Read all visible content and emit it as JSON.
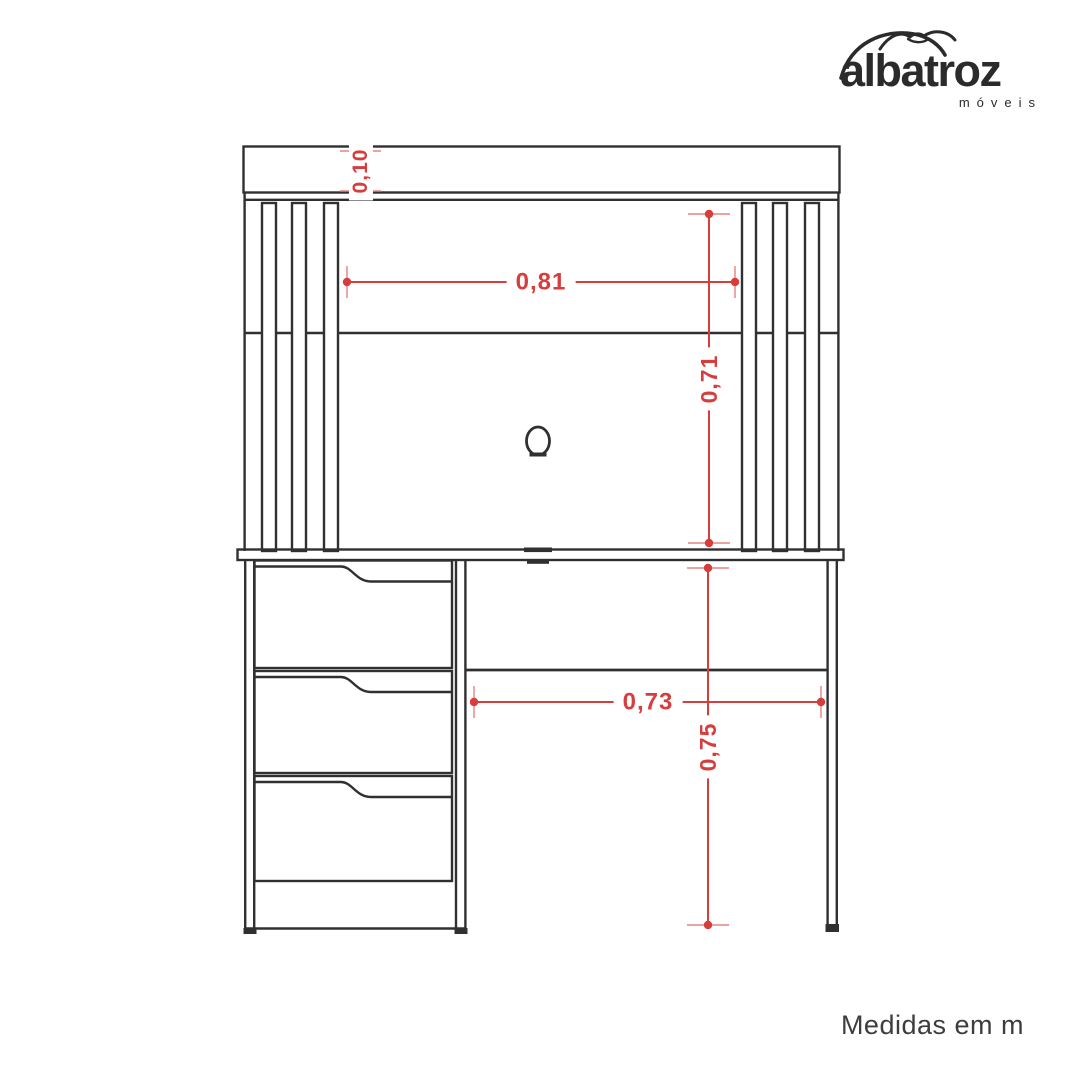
{
  "logo": {
    "brand": "albatroz",
    "subtitle": "móveis"
  },
  "diagram": {
    "unit_note": "Medidas em m",
    "dimensions": {
      "header_height": "0,10",
      "inner_width": "0,81",
      "hutch_height": "0,71",
      "desk_inner_width": "0,73",
      "desk_height": "0,75"
    }
  },
  "colors": {
    "line": "#303030",
    "dimension_red": "#d83d3d",
    "dimension_tick": "#e5837f",
    "text_dark": "#2b2b2b"
  }
}
